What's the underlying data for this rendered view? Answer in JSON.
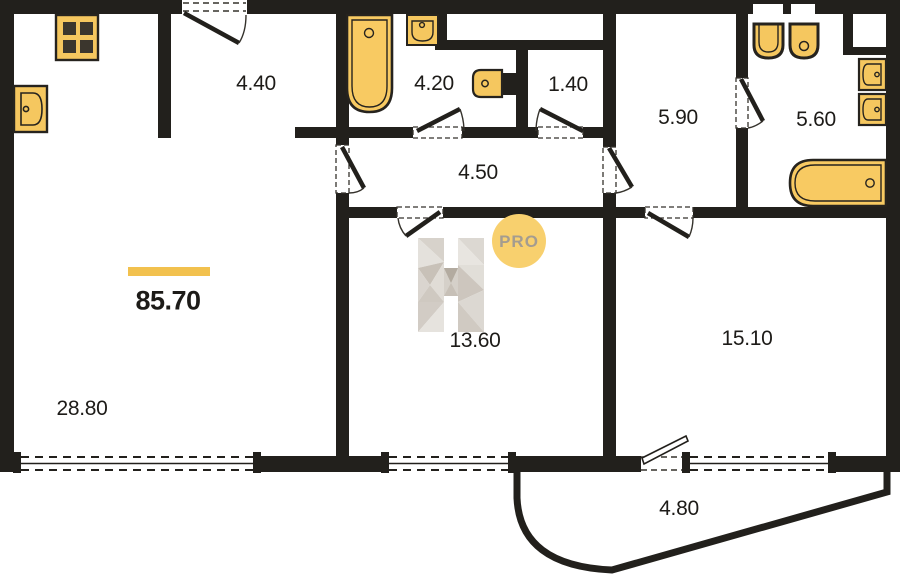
{
  "plan": {
    "type": "apartment-floor-plan",
    "total_area": {
      "value": "85.70"
    },
    "rooms": [
      {
        "id": "entry-hall",
        "area": "4.40"
      },
      {
        "id": "bathroom",
        "area": "4.20"
      },
      {
        "id": "wc",
        "area": "1.40"
      },
      {
        "id": "hallway",
        "area": "4.50"
      },
      {
        "id": "dressing-room",
        "area": "5.90"
      },
      {
        "id": "bathroom-2",
        "area": "5.60"
      },
      {
        "id": "room",
        "area": "13.60"
      },
      {
        "id": "bedroom",
        "area": "15.10"
      },
      {
        "id": "living-kitchen",
        "area": "28.80"
      },
      {
        "id": "balcony",
        "area": "4.80"
      }
    ],
    "fixtures": [
      "stove-icon",
      "kitchen-sink-icon",
      "bathtub-vertical-icon",
      "small-sink-icon",
      "toilet-icon",
      "toilet-icon",
      "toilet-icon",
      "wall-sink-icon",
      "wall-sink-icon",
      "bathtub-horizontal-icon"
    ],
    "watermark": {
      "letter": "H",
      "badge": "PRO"
    },
    "colors": {
      "wall": "#22201c",
      "fixture_fill": "#f5c75f",
      "accent_bar": "#f2c14e",
      "watermark_badge": "#f8d06e",
      "watermark_text": "#a49c90"
    }
  }
}
